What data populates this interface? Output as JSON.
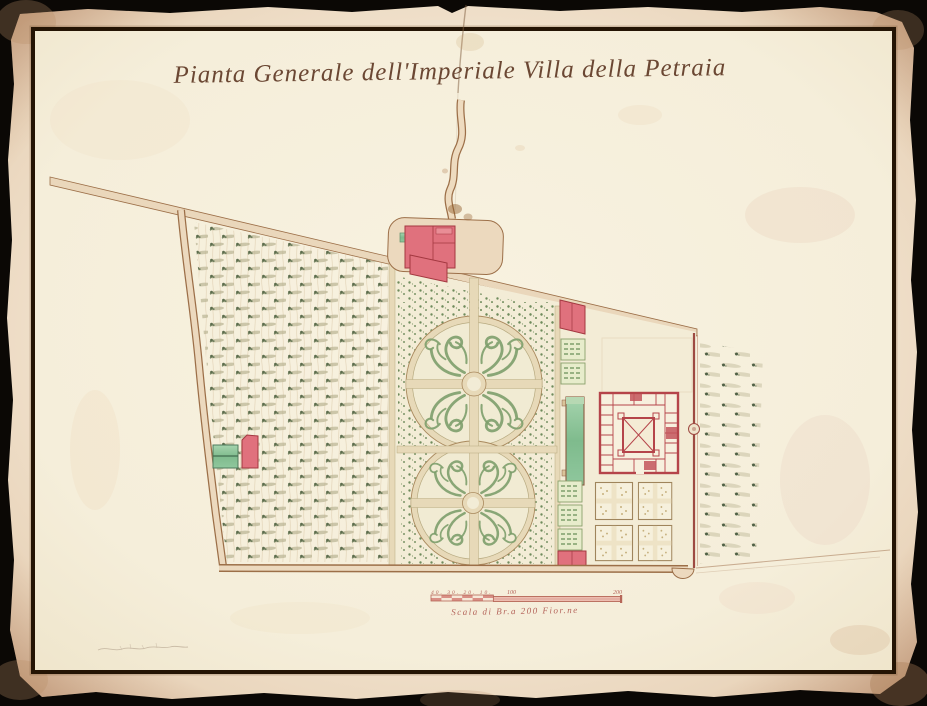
{
  "title": "Pianta Generale dell'Imperiale Villa della Petraia",
  "scale_bar": {
    "minor_ticks": "40. 30. 20. 10.",
    "mid_label": "100",
    "end_label": "200",
    "caption": "Scala di Br.a 200 Fior.ne"
  },
  "colors": {
    "backdrop": "#0b0805",
    "paper_outer": "#f2e4d0",
    "paper_map": "#f7f1de",
    "frame_ink": "#241404",
    "road_tan": "#ead7bb",
    "road_edge": "#9c6f48",
    "path_tan": "#e7d9b8",
    "bed_cream": "#f3ecd6",
    "building_red": "#e0717d",
    "building_outline": "#a33840",
    "villa_red": "#b5444a",
    "pond_green": "#8cc49a",
    "parterre_green": "#7d9f6b",
    "shrub_green": "#6f8b5c",
    "tree_dark": "#5d6e4e",
    "shadow_olive": "#b9b493",
    "scale_red": "#b4635a",
    "title_ink": "#6b4733"
  }
}
